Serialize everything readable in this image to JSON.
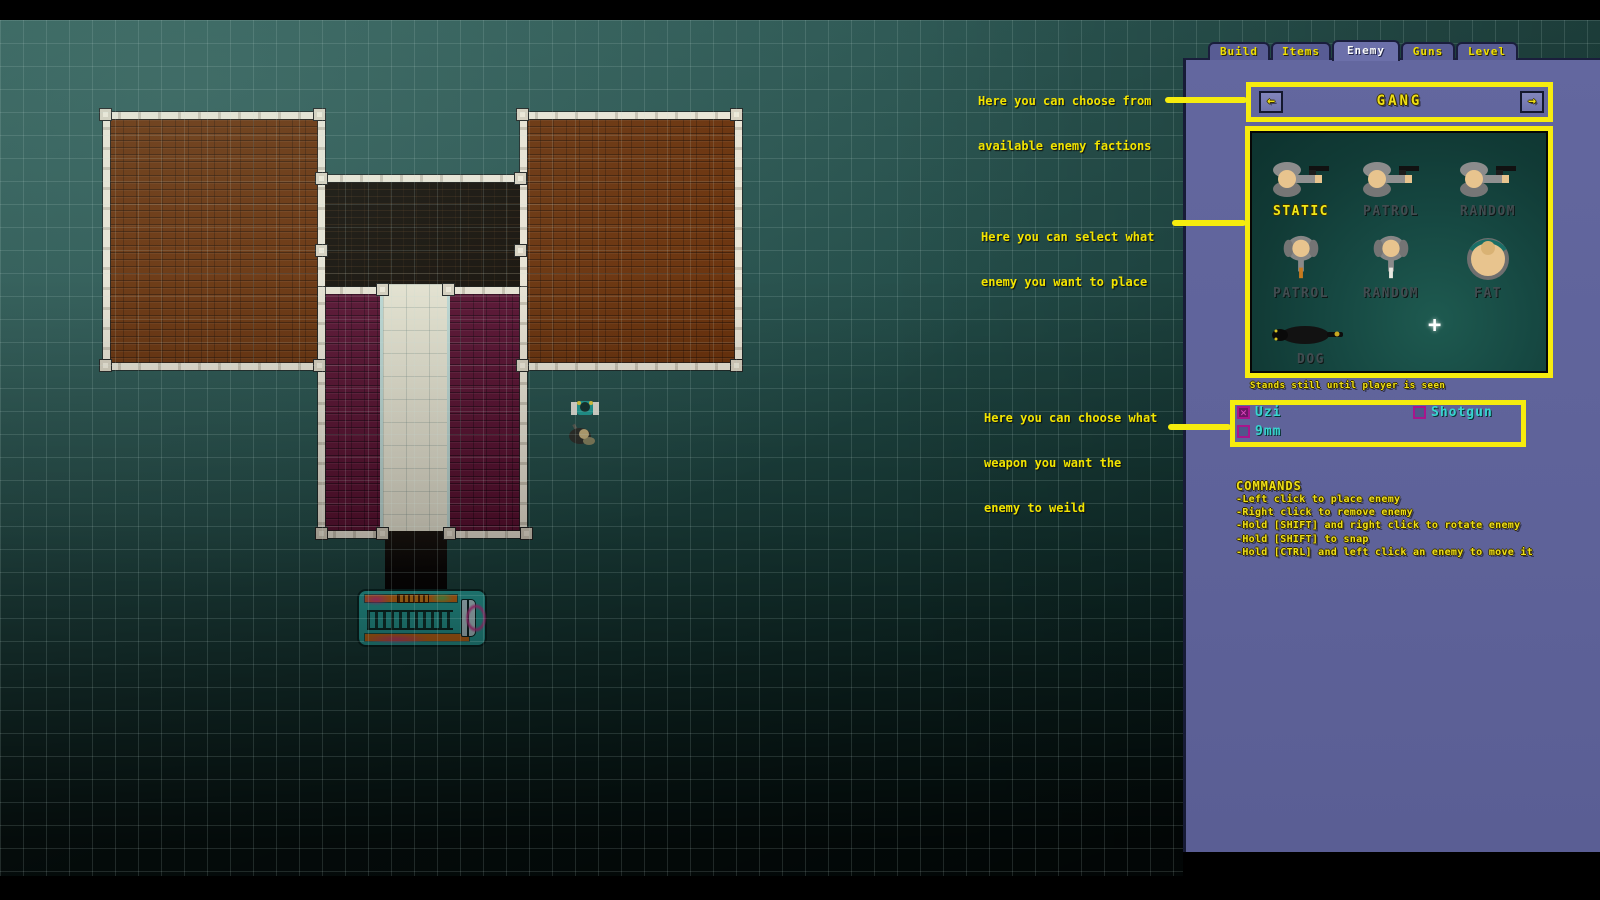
{
  "editor": {
    "tabs": [
      {
        "label": "Build",
        "active": false
      },
      {
        "label": "Items",
        "active": false
      },
      {
        "label": "Enemy",
        "active": true
      },
      {
        "label": "Guns",
        "active": false
      },
      {
        "label": "Level",
        "active": false
      }
    ],
    "faction": {
      "label": "GANG",
      "prev_icon": "←",
      "next_icon": "→"
    },
    "enemy_types": [
      {
        "label": "STATIC",
        "selected": true
      },
      {
        "label": "PATROL",
        "selected": false
      },
      {
        "label": "RANDOM",
        "selected": false
      },
      {
        "label": "PATROL",
        "selected": false
      },
      {
        "label": "RANDOM",
        "selected": false
      },
      {
        "label": "FAT",
        "selected": false
      },
      {
        "label": "DOG",
        "selected": false
      }
    ],
    "cursor_glyph": "+",
    "selected_enemy_tooltip": "Stands still until player is seen",
    "weapons": [
      {
        "label": "Uzi",
        "checked": true,
        "mark": "✕"
      },
      {
        "label": "Shotgun",
        "checked": false,
        "mark": ""
      },
      {
        "label": "9mm",
        "checked": false,
        "mark": ""
      }
    ],
    "commands": {
      "title": "COMMANDS",
      "items": [
        "-Left click to place enemy",
        "-Right click to remove enemy",
        "-Hold [SHIFT] and right click to rotate enemy",
        "-Hold [SHIFT] to snap",
        "-Hold [CTRL] and left click an enemy to move it"
      ]
    }
  },
  "annotations": [
    {
      "lines": [
        "Here you can choose from",
        "available enemy factions"
      ]
    },
    {
      "lines": [
        "Here you can select what",
        "enemy you want to place"
      ]
    },
    {
      "lines": [
        "Here you can choose what",
        "weapon you want the",
        "enemy to weild"
      ]
    }
  ],
  "colors": {
    "annotation_yellow": "#f6ec0e",
    "panel_purple": "#60649c",
    "pixel_text_yellow": "#efdf16",
    "active_tab_text": "#fafafa",
    "weapon_text_cyan": "#38d4d0",
    "checkbox_magenta": "#a8158c",
    "map_teal": "#2e5a56",
    "brick_brown": "#6b2f08",
    "carpet_purple": "#5a0e2f",
    "carpet_cream": "#ebe6d4",
    "bus_teal": "#2db4ac",
    "bus_orange": "#e0791b"
  }
}
